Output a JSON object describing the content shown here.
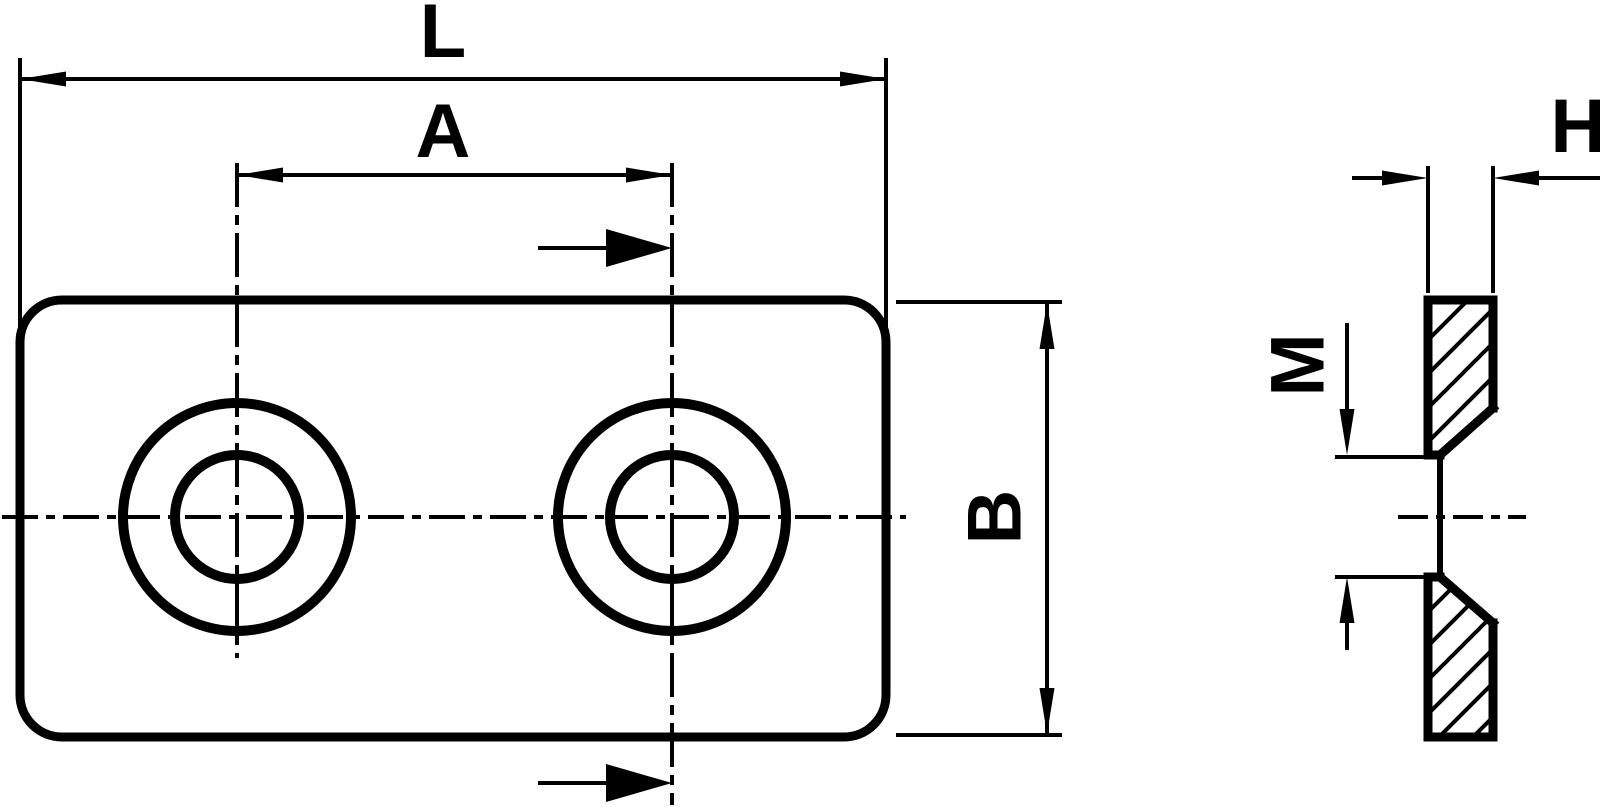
{
  "meta": {
    "type": "technical-drawing",
    "description": "Mounting plate with two countersunk holes: front view (left) and side section view (right)",
    "background_color": "#ffffff",
    "line_color": "#000000"
  },
  "dimensions": {
    "length_label": "L",
    "hole_spacing_label": "A",
    "width_label": "B",
    "thickness_label": "H",
    "thread_label": "M"
  }
}
